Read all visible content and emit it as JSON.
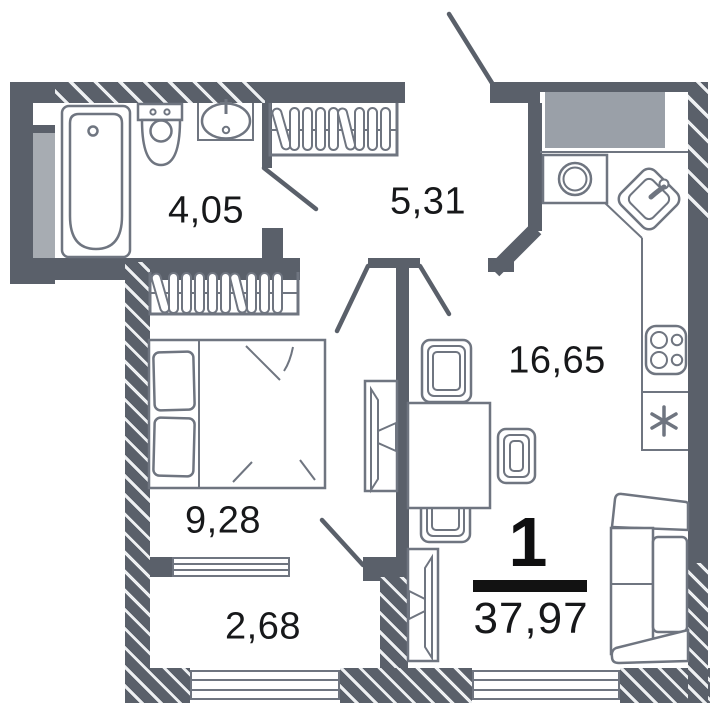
{
  "plan": {
    "type": "apartment-floor-plan",
    "unit": {
      "rooms_count": "1",
      "total_area": "37,97"
    },
    "rooms": [
      {
        "name": "bathroom",
        "area": "4,05"
      },
      {
        "name": "hallway",
        "area": "5,31"
      },
      {
        "name": "kitchen-living-room",
        "area": "16,65"
      },
      {
        "name": "bedroom",
        "area": "9,28"
      },
      {
        "name": "balcony",
        "area": "2,68"
      }
    ],
    "colors": {
      "wall": "#5a606a",
      "fixture_outline": "#6f7580",
      "label_text": "#17181a",
      "marker": "#121212",
      "kitchen_block_fill": "#9aa0a8",
      "shaft_fill": "#a7acb2",
      "floor": "#ffffff"
    },
    "icons": {
      "fridge_symbol": "*",
      "fixtures": [
        "bathtub",
        "toilet",
        "sink",
        "wardrobe-hangers",
        "bed",
        "tv",
        "dining-table",
        "chair",
        "sofa",
        "washing-machine",
        "corner-sink",
        "stove",
        "fridge",
        "window",
        "door-swing"
      ]
    }
  }
}
